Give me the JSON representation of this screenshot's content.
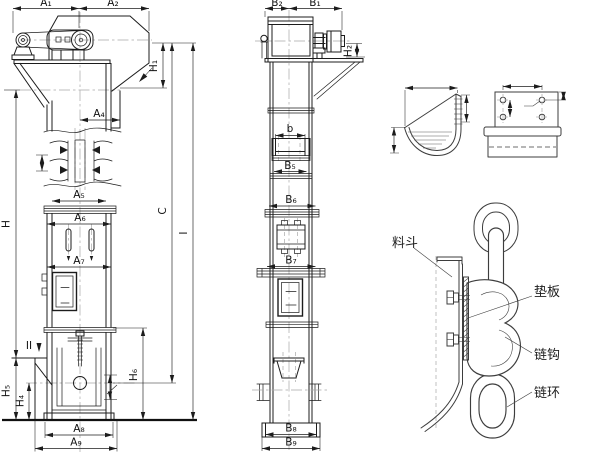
{
  "drawing": {
    "kind": "bucket elevator general-arrangement drawing",
    "views": [
      "side elevation",
      "front elevation",
      "bucket detail",
      "mounting plate detail",
      "chain attachment detail"
    ]
  },
  "dims": {
    "a1": "A₁",
    "a2": "A₂",
    "a4": "A₄",
    "a5": "A₅",
    "a6": "A₆",
    "a7": "A₇",
    "a8": "A₈",
    "a9": "A₉",
    "b1": "B₁",
    "b2": "B₂",
    "b": "b",
    "b5": "B₅",
    "b6": "B₆",
    "b7": "B₇",
    "b8": "B₈",
    "b9": "B₉",
    "h": "H",
    "h1": "H₁",
    "h2": "H₂",
    "h4": "H₄",
    "h5": "H₅",
    "h6": "H₆",
    "c": "C",
    "i": "I",
    "section2": "II"
  },
  "callouts": {
    "bucket": "料斗",
    "pad_plate": "垫板",
    "chain_hook": "链钩",
    "chain_link": "链环"
  },
  "colors": {
    "line": "#1c1c1c",
    "detail_line": "#3d3d3d",
    "centerline": "#a9a9a9",
    "background": "#ffffff"
  }
}
